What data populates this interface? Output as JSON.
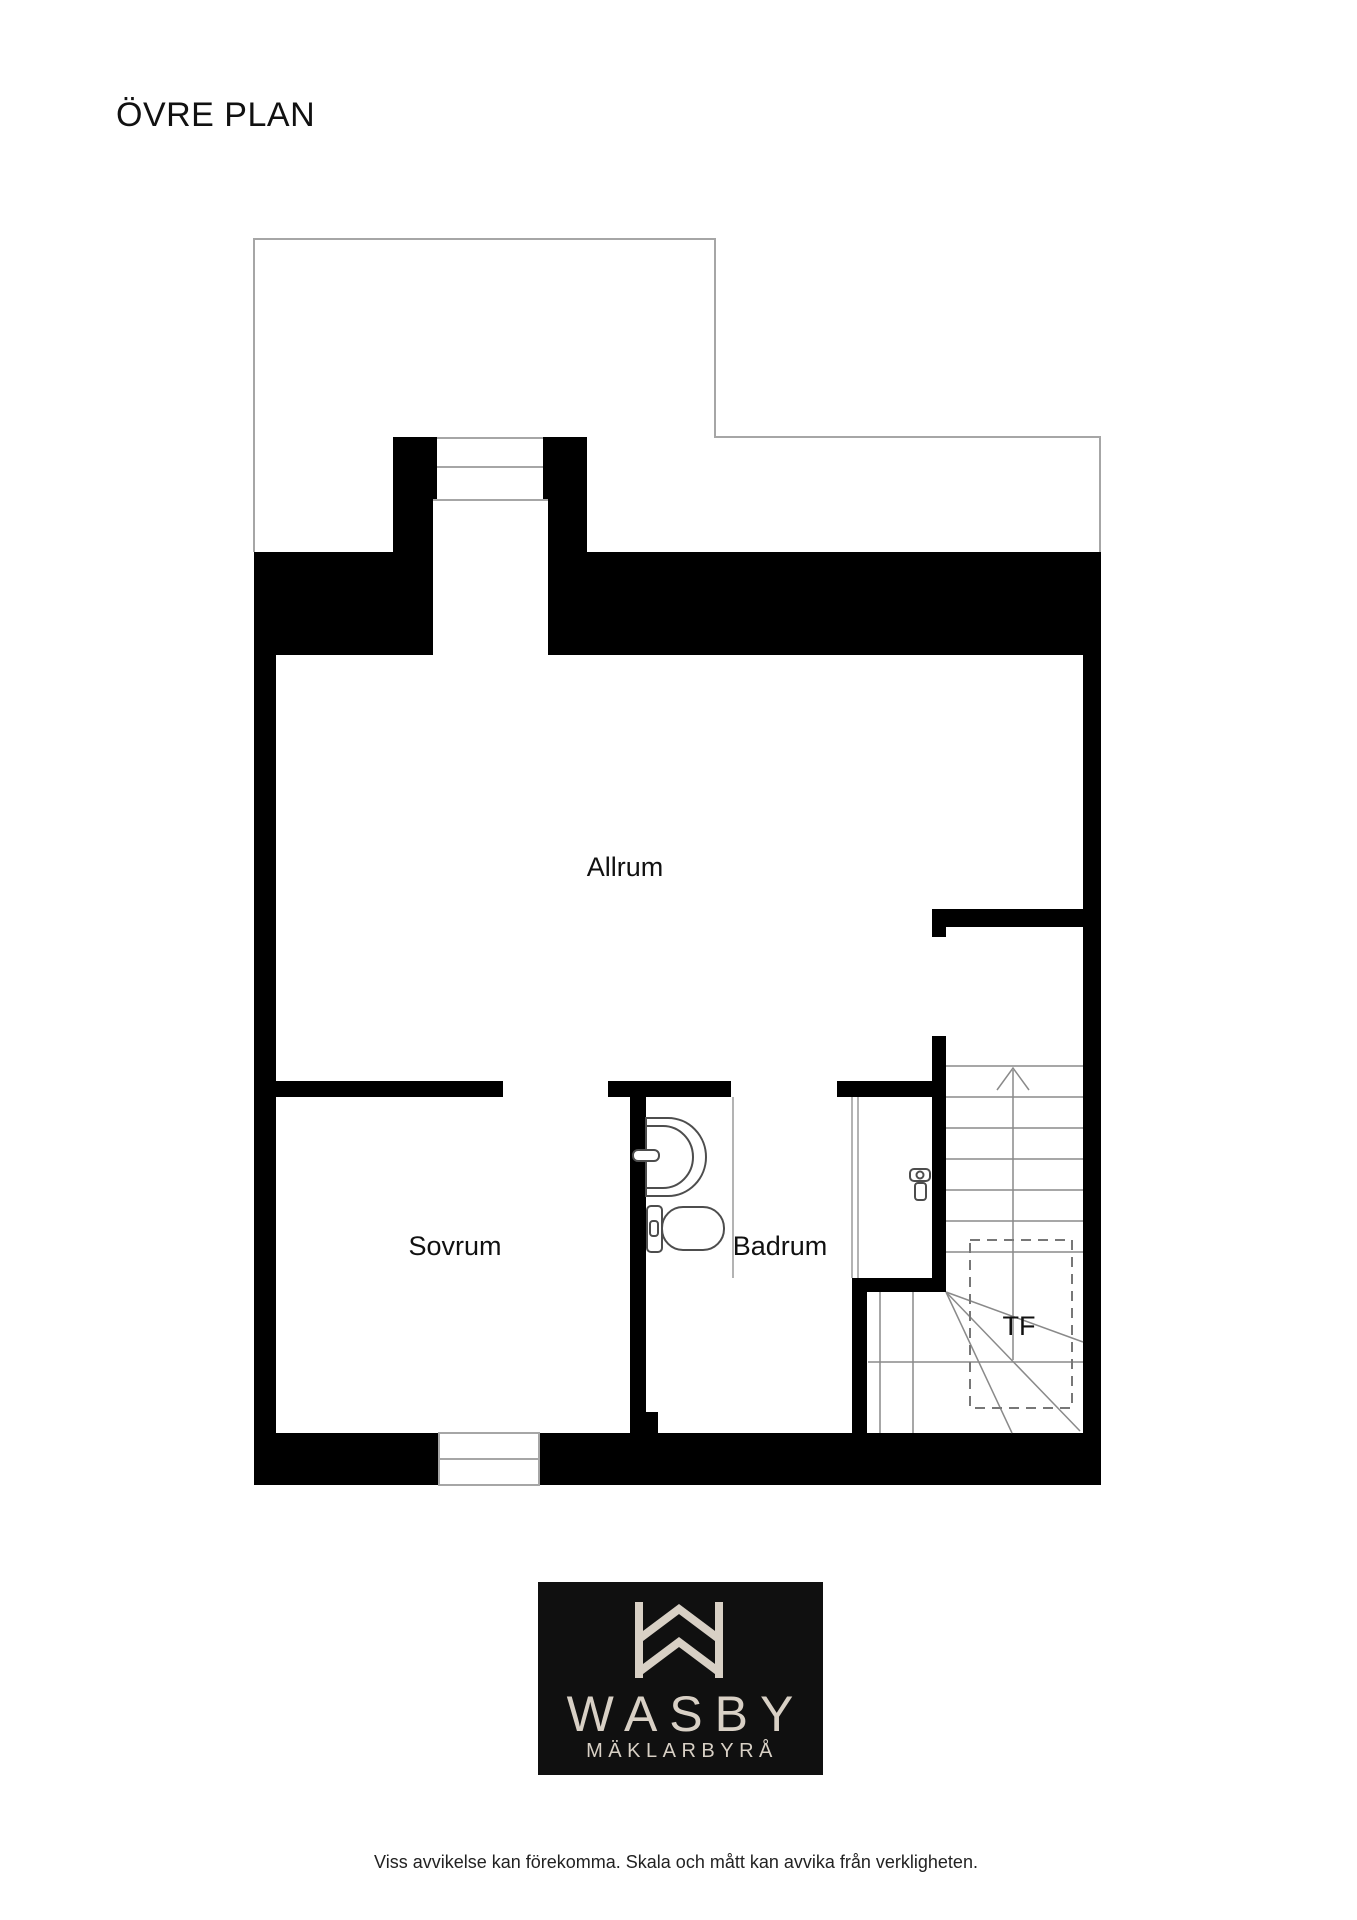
{
  "page": {
    "title": "ÖVRE PLAN"
  },
  "rooms": {
    "allrum": "Allrum",
    "sovrum": "Sovrum",
    "badrum": "Badrum",
    "tf": "TF"
  },
  "colors": {
    "wall": "#000000",
    "terrace_outline": "#a6a6a6",
    "stair_line": "#8a8a8a",
    "fixture_line": "#4d4d4d",
    "dashed_line": "#777777"
  },
  "logo": {
    "brand": "WASBY",
    "tagline": "MÄKLARBYRÅ",
    "background": "#101010",
    "foreground": "#d8d0c5"
  },
  "footer": {
    "disclaimer": "Viss avvikelse kan förekomma. Skala och mått kan avvika från verkligheten."
  }
}
